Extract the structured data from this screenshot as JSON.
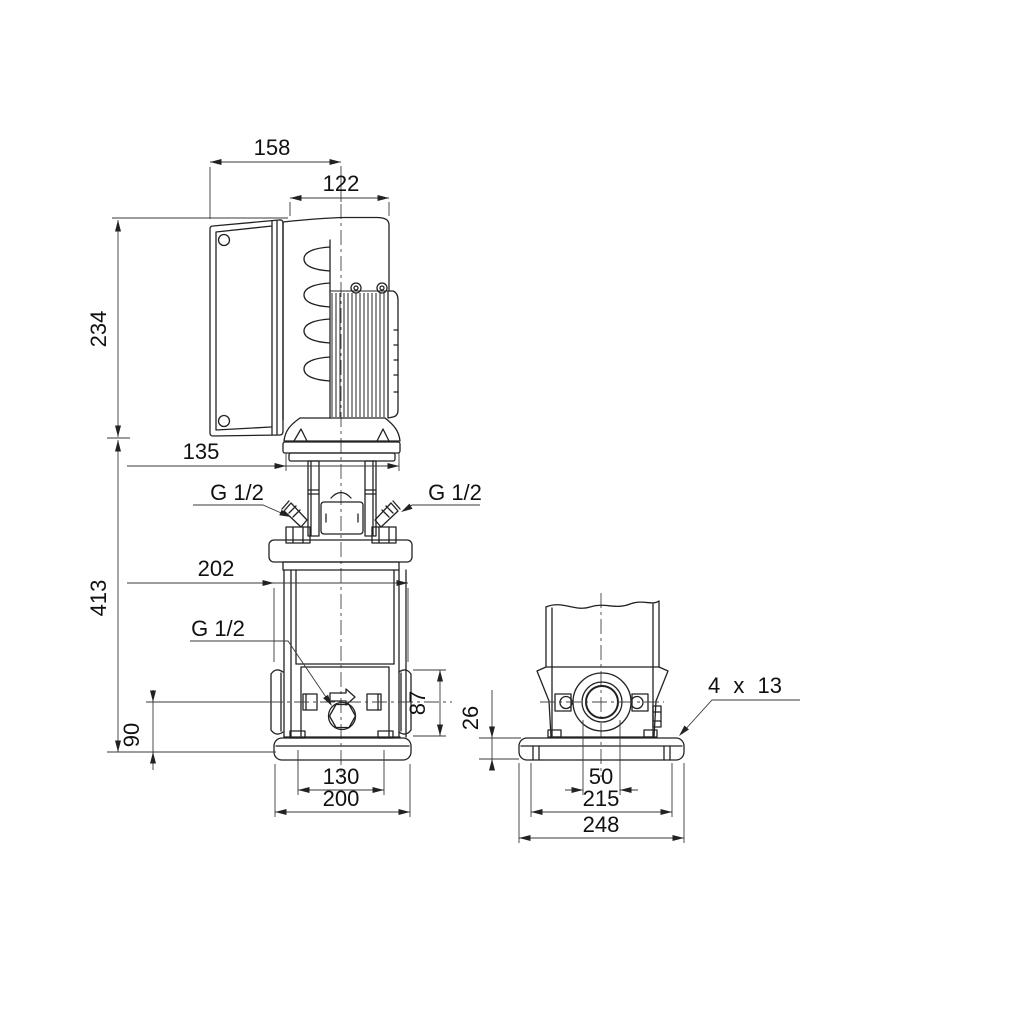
{
  "front_view": {
    "dim_158": "158",
    "dim_122": "122",
    "dim_234": "234",
    "dim_135": "135",
    "dim_202": "202",
    "dim_413": "413",
    "dim_90": "90",
    "dim_87": "87",
    "dim_130": "130",
    "dim_200": "200",
    "vent_plug_left_label": "G 1/2",
    "vent_plug_right_label": "G 1/2",
    "drain_plug_label": "G 1/2"
  },
  "side_view": {
    "dim_26": "26",
    "dim_50": "50",
    "dim_215": "215",
    "dim_248": "248",
    "base_holes_label": "4 x 13"
  },
  "colors": {
    "line": "#222222",
    "background": "#ffffff"
  }
}
